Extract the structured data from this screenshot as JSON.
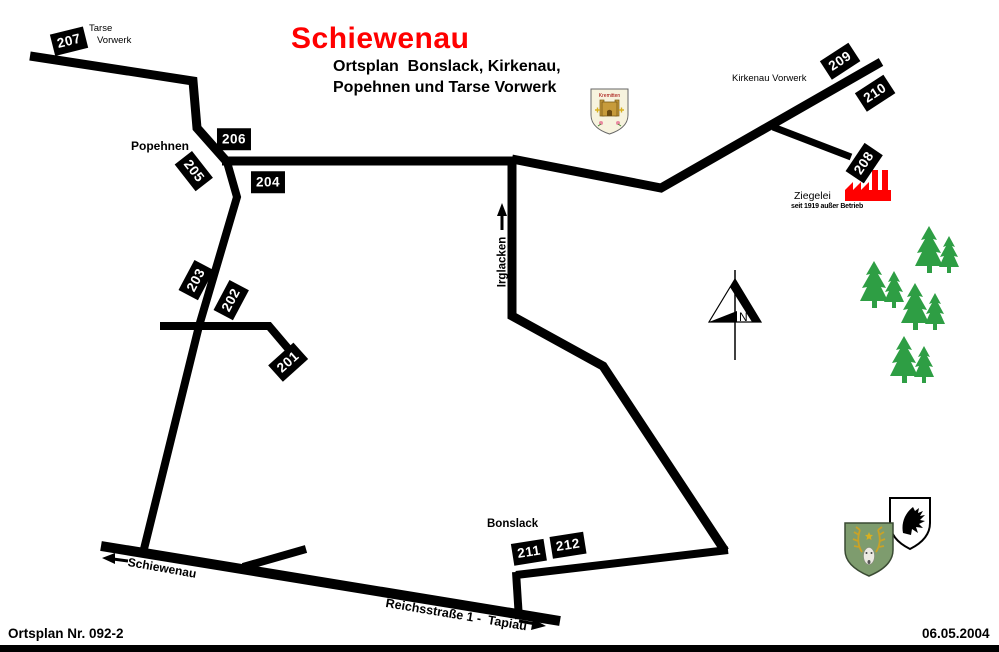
{
  "title": "Schiewenau",
  "subtitle": {
    "line1": "Ortsplan  Bonslack, Kirkenau,",
    "line2": "Popehnen und Tarse Vorwerk"
  },
  "road_markers": {
    "m201": "201",
    "m202": "202",
    "m203": "203",
    "m204": "204",
    "m205": "205",
    "m206": "206",
    "m207": "207",
    "m208": "208",
    "m209": "209",
    "m210": "210",
    "m211": "211",
    "m212": "212"
  },
  "places": {
    "tarse_vorwerk_line1": "Tarse",
    "tarse_vorwerk_line2": "Vorwerk",
    "popehnen": "Popehnen",
    "kirkenau_vorwerk": "Kirkenau Vorwerk",
    "irglacken": "Irglacken",
    "bonslack": "Bonslack",
    "ziegelei": "Ziegelei",
    "ziegelei_note": "seit 1919 außer Betrieb",
    "schiewenau_direction": "Schiewenau",
    "reichsstrasse": "Reichsstraße 1 -  Tapiau"
  },
  "compass": {
    "label": "N"
  },
  "heraldry": {
    "parish_label": "Kremitten"
  },
  "footer": {
    "plan_number": "Ortsplan Nr. 092-2",
    "date": "06.05.2004"
  },
  "colors": {
    "road": "#000000",
    "title_red": "#ff0000",
    "factory_red": "#ff0000",
    "tree_green": "#2e9e44",
    "marker_bg": "#000000",
    "marker_text": "#ffffff",
    "stag_shield_green": "#7e9c6e",
    "antler_gold": "#c9a227"
  }
}
